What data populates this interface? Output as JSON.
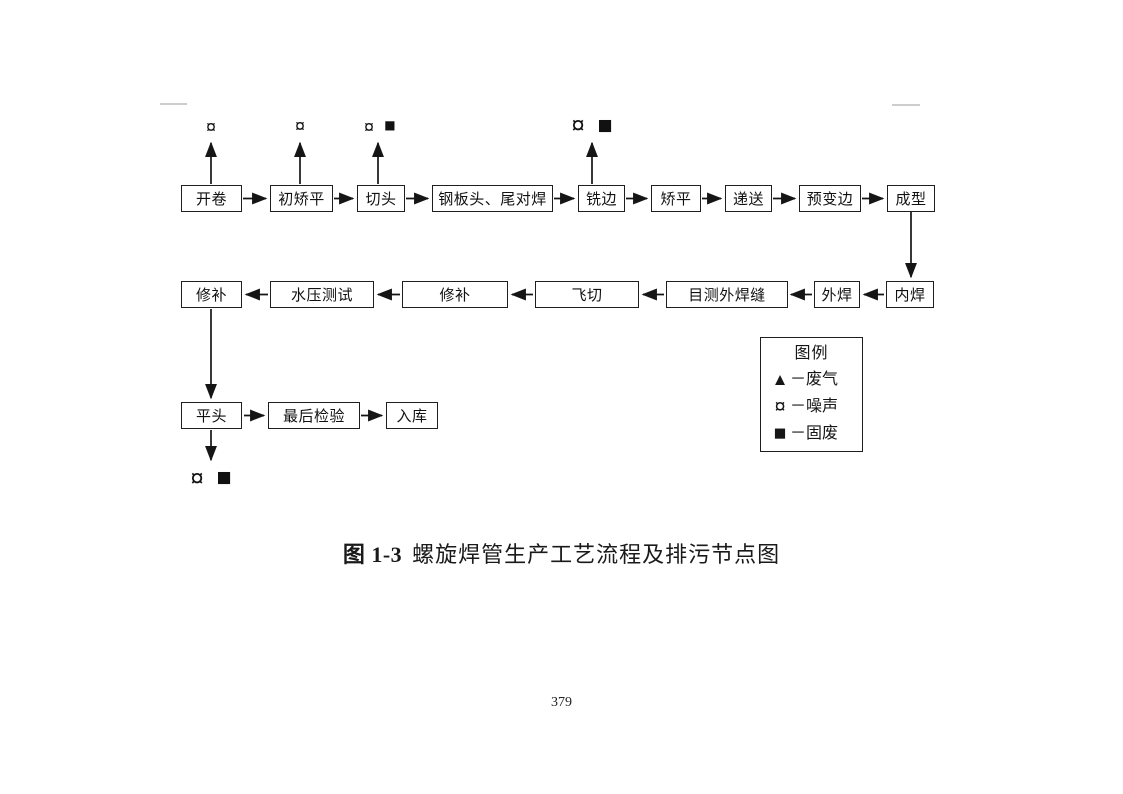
{
  "flow": {
    "row1": [
      "开卷",
      "初矫平",
      "切头",
      "钢板头、尾对焊",
      "铣边",
      "矫平",
      "递送",
      "预变边",
      "成型"
    ],
    "row2": [
      "修补",
      "水压测试",
      "修补",
      "飞切",
      "目测外焊缝",
      "外焊",
      "内焊"
    ],
    "row3": [
      "平头",
      "最后检验",
      "入库"
    ]
  },
  "markers": {
    "kaijuan_noise": "¤",
    "chujiaoping_noise": "¤",
    "qietou_noise": "¤",
    "qietou_solid": "■",
    "xibian_noise": "¤",
    "xibian_solid": "■",
    "pingtou_noise": "¤",
    "pingtou_solid": "■"
  },
  "legend": {
    "title": "图例",
    "items": [
      {
        "symbol": "▲",
        "sep": "－",
        "label": "废气"
      },
      {
        "symbol": "¤",
        "sep": "－",
        "label": "噪声"
      },
      {
        "symbol": "■",
        "sep": "－",
        "label": "固废"
      }
    ]
  },
  "caption": {
    "figure_no": "图 1-3",
    "title": "螺旋焊管生产工艺流程及排污节点图"
  },
  "page_number": "379"
}
